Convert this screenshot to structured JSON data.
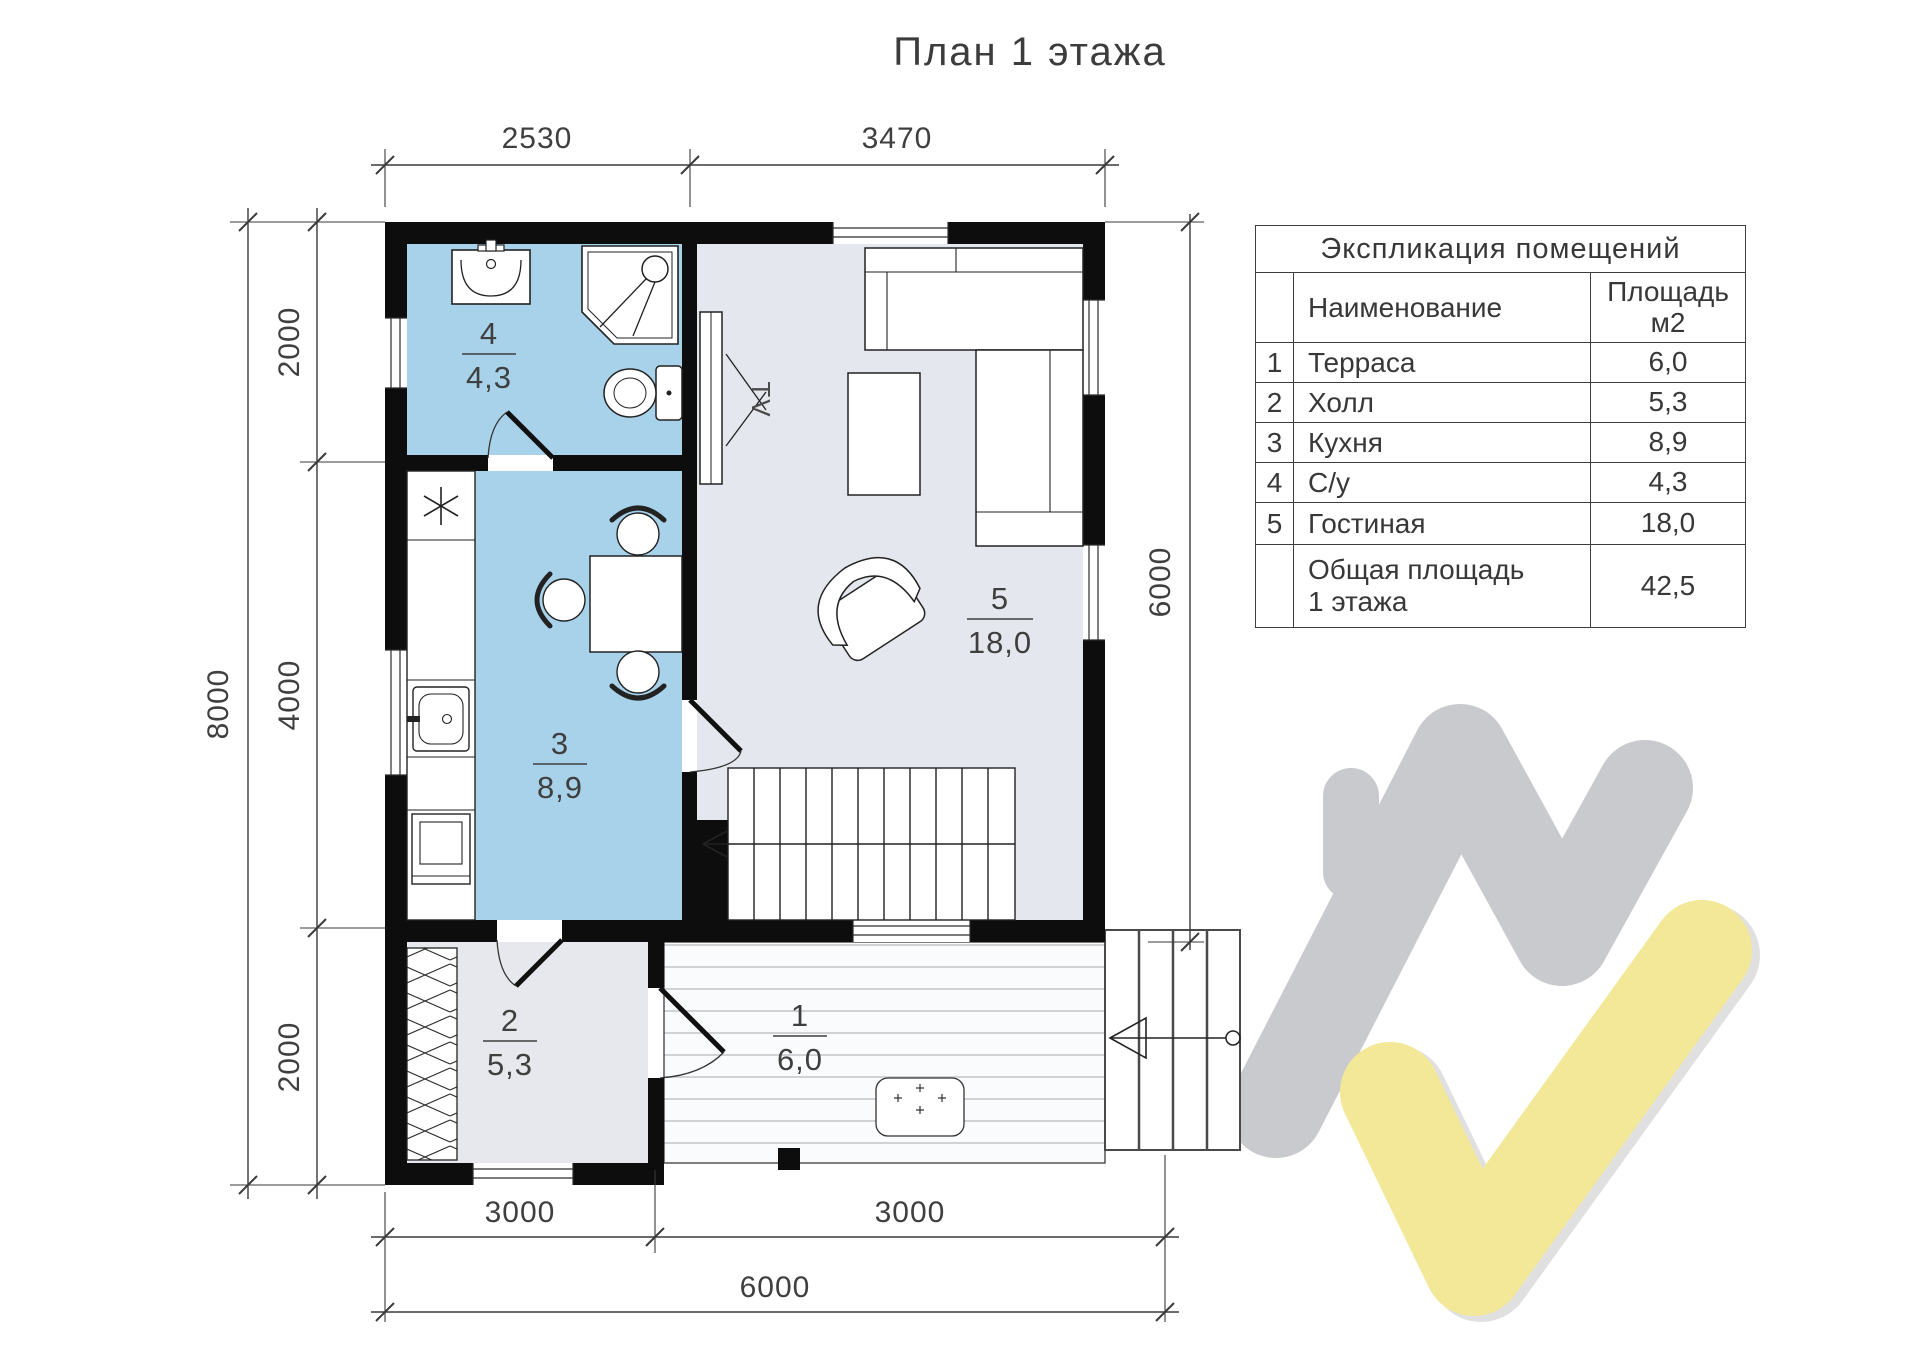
{
  "title": "План 1 этажа",
  "explication": {
    "title": "Экспликация помещений",
    "col_name": "Наименование",
    "col_area_line1": "Площадь",
    "col_area_line2": "м2",
    "rows": [
      {
        "num": "1",
        "name": "Терраса",
        "area": "6,0"
      },
      {
        "num": "2",
        "name": "Холл",
        "area": "5,3"
      },
      {
        "num": "3",
        "name": "Кухня",
        "area": "8,9"
      },
      {
        "num": "4",
        "name": "С/у",
        "area": "4,3"
      },
      {
        "num": "5",
        "name": "Гостиная",
        "area": "18,0"
      }
    ],
    "total": {
      "label_line1": "Общая площадь",
      "label_line2": "1 этажа",
      "area": "42,5"
    }
  },
  "plan": {
    "tv_label": "TV"
  },
  "dimensions": {
    "top": [
      "2530",
      "3470"
    ],
    "left_outer": "8000",
    "left_inner": [
      "2000",
      "4000",
      "2000"
    ],
    "right": "6000",
    "bottom": [
      "3000",
      "3000"
    ],
    "bottom_total": "6000"
  },
  "colors": {
    "wet_room_fill": "#a8d1ea",
    "living_fill": "#e4e7ed",
    "hall_fill": "#e6e8ed",
    "wall": "#0d0d0d",
    "logo_gray": "#c9cacd",
    "logo_yellow": "#f3e897"
  }
}
